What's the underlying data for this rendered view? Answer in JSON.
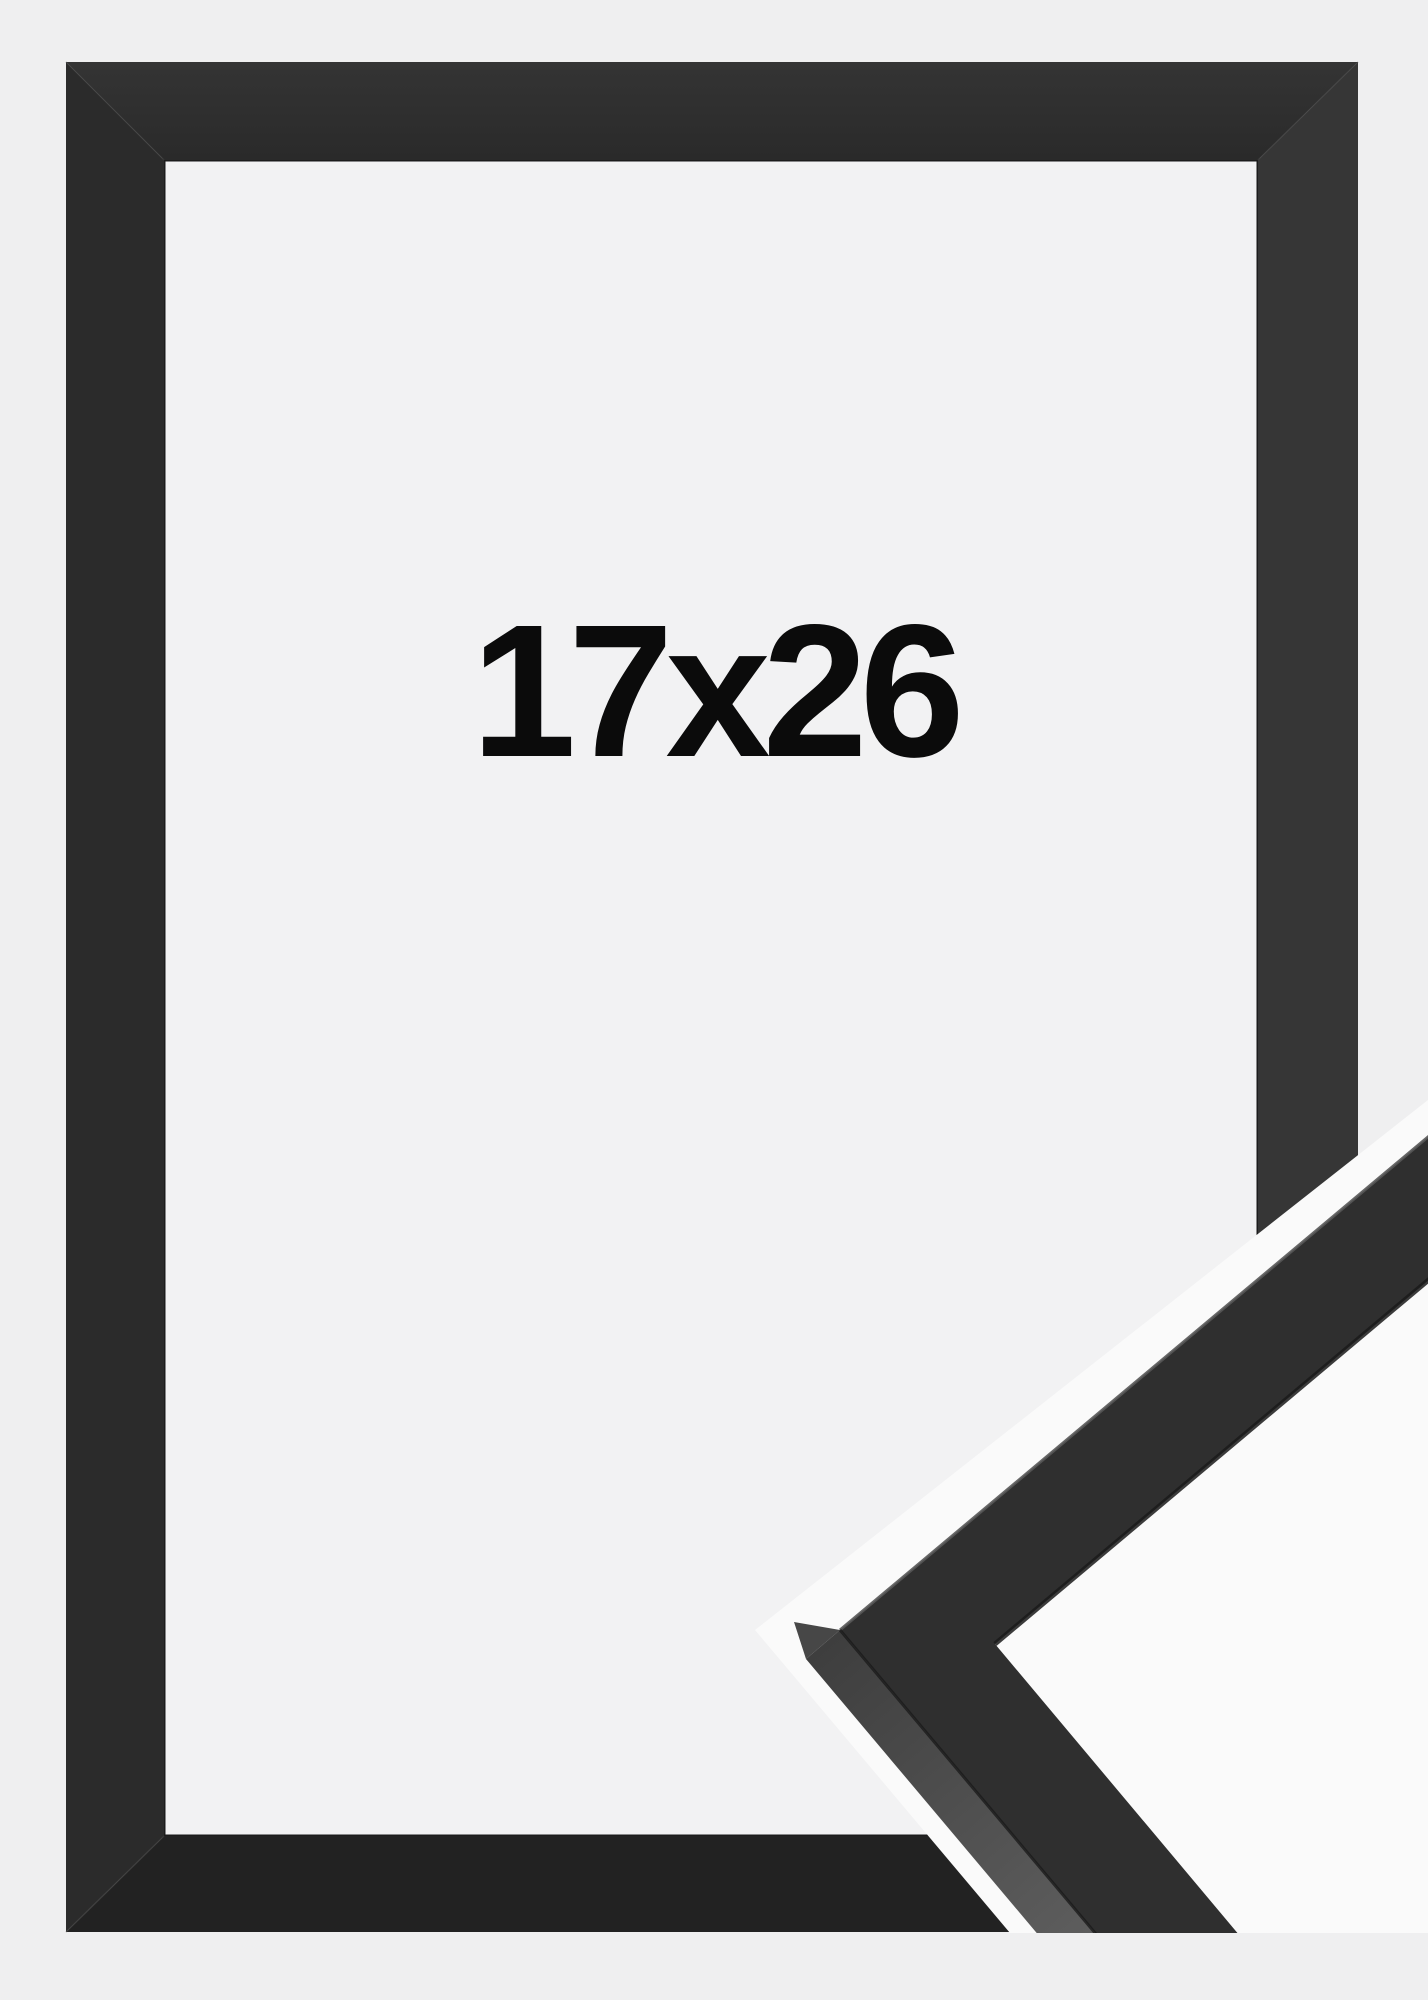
{
  "product": {
    "size_label": "17x26",
    "frame_color_name": "black",
    "item_type": "picture-frame"
  },
  "scene": {
    "background_color": "#efeff0",
    "detail_photo_background_color": "#fafafa",
    "frame_front_color": "#2e2e2e",
    "frame_top_band_color": "#2f2f2f",
    "frame_left_band_color": "#2b2b2b",
    "frame_right_band_color": "#363636",
    "frame_bottom_band_color": "#222222",
    "frame_side_face_color": "#4a4a4a",
    "opening_color": "#f2f2f3",
    "label_text_color": "#0b0b0b"
  }
}
